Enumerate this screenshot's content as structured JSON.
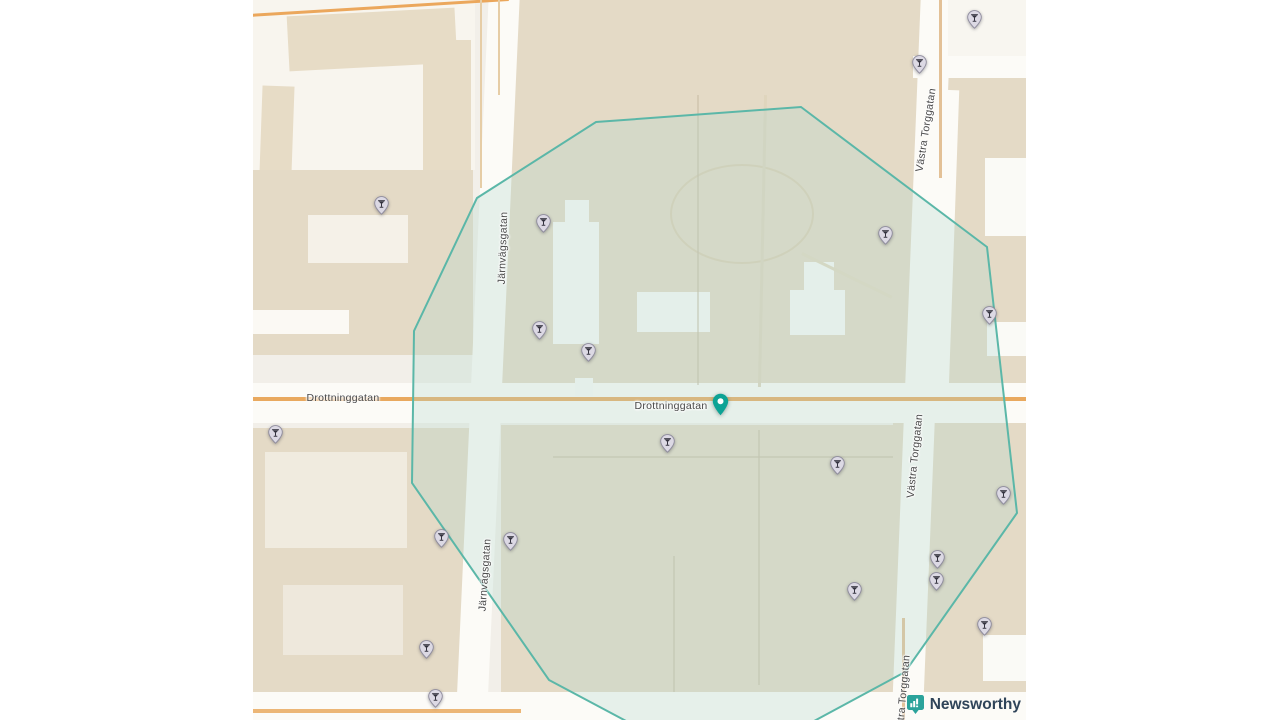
{
  "branding": {
    "name": "Newsworthy",
    "icon": "bar-chart-speech-bubble-icon",
    "icon_color": "#2ba39b",
    "text_color": "#2f4459"
  },
  "map": {
    "street_labels": [
      {
        "text": "Drottninggatan",
        "x": 90,
        "y": 398,
        "rotate": 0
      },
      {
        "text": "Drottninggatan",
        "x": 418,
        "y": 406,
        "rotate": 0
      },
      {
        "text": "Järnvägsgatan",
        "x": 250,
        "y": 248,
        "rotate": -88
      },
      {
        "text": "Järnvägsgatan",
        "x": 232,
        "y": 575,
        "rotate": -86
      },
      {
        "text": "Västra Torggatan",
        "x": 673,
        "y": 130,
        "rotate": -81
      },
      {
        "text": "Västra Torggatan",
        "x": 662,
        "y": 456,
        "rotate": -84
      },
      {
        "text": "Västra Torggatan",
        "x": 650,
        "y": 697,
        "rotate": -85
      }
    ],
    "selected_pin": {
      "x": 467,
      "y": 416,
      "color": "#0da395",
      "icon": "location-pin-icon"
    },
    "bar_markers": {
      "icon": "cocktail-glass-icon",
      "pin_fill": "#dcd9e4",
      "pin_stroke": "#8f8c9e",
      "glyph_color": "#33323e",
      "points": [
        {
          "x": 721,
          "y": 17
        },
        {
          "x": 666,
          "y": 62
        },
        {
          "x": 128,
          "y": 203
        },
        {
          "x": 290,
          "y": 221
        },
        {
          "x": 632,
          "y": 233
        },
        {
          "x": 736,
          "y": 313
        },
        {
          "x": 286,
          "y": 328
        },
        {
          "x": 335,
          "y": 350
        },
        {
          "x": 22,
          "y": 432
        },
        {
          "x": 414,
          "y": 441
        },
        {
          "x": 584,
          "y": 463
        },
        {
          "x": 750,
          "y": 493
        },
        {
          "x": 188,
          "y": 536
        },
        {
          "x": 257,
          "y": 539
        },
        {
          "x": 684,
          "y": 557
        },
        {
          "x": 683,
          "y": 579
        },
        {
          "x": 601,
          "y": 589
        },
        {
          "x": 731,
          "y": 624
        },
        {
          "x": 173,
          "y": 647
        },
        {
          "x": 182,
          "y": 696
        }
      ]
    },
    "radius_polygon": {
      "points": "548,107 734,247 764,513 652,672 537,734 390,730 296,680 159,483 161,331 224,198 343,122",
      "stroke_color": "#5bb7a8",
      "fill_color": "rgba(178,214,204,0.30)"
    }
  }
}
